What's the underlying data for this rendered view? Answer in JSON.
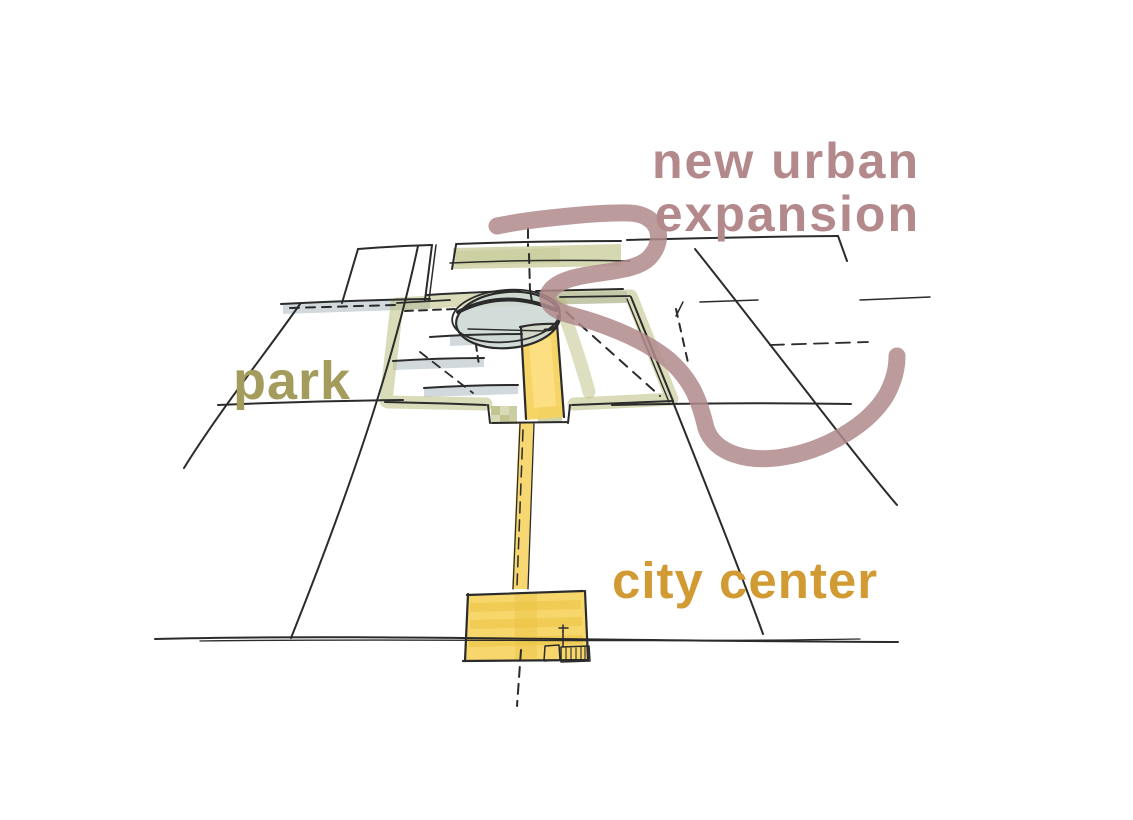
{
  "labels": {
    "expansion": {
      "line1": "new urban",
      "line2": "expansion",
      "color": "#b3898c"
    },
    "park": {
      "text": "park",
      "color": "#a49c5c"
    },
    "city_center": {
      "text": "city center",
      "color": "#d19a33"
    }
  },
  "colors": {
    "background": "#ffffff",
    "sketch_line": "#2b2b2b",
    "park_band": "#b5b873",
    "park_band_checker": "#a9ad62",
    "axis_yellow": "#f6d25e",
    "axis_yellow_highlight": "#fce189",
    "axis_yellow_stripe": "#e9c23f",
    "plaza_fill": "#cdd8d4",
    "street_strip": "#c6d0d4",
    "expansion_stroke": "#b08a8c"
  }
}
